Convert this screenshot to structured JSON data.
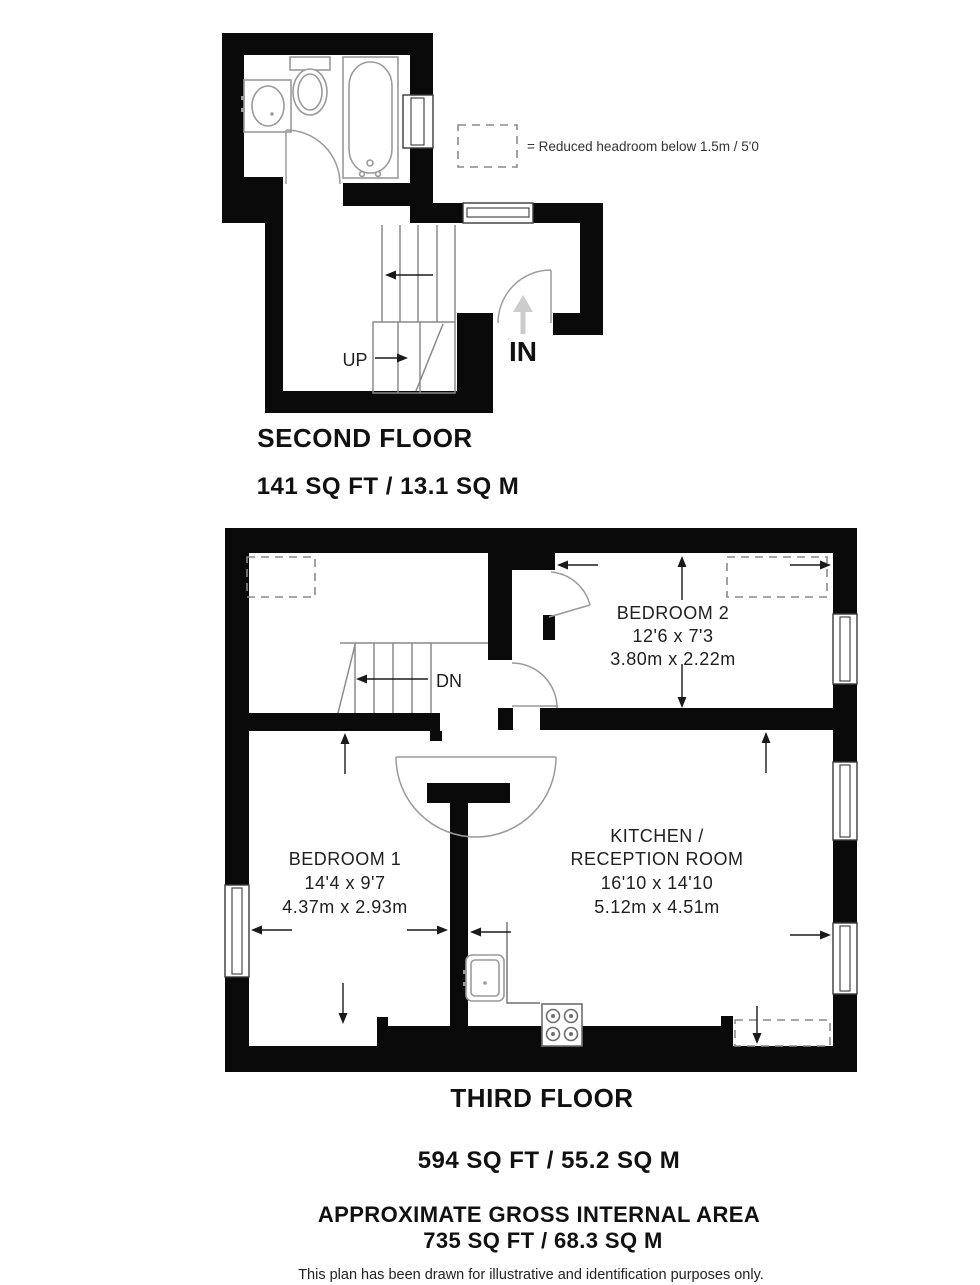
{
  "legend": {
    "label": "= Reduced headroom below 1.5m / 5'0"
  },
  "second_floor": {
    "title": "SECOND FLOOR",
    "area": "141 SQ FT / 13.1 SQ M",
    "stair_label": "UP",
    "entry_label": "IN"
  },
  "third_floor": {
    "title": "THIRD FLOOR",
    "area": "594 SQ FT / 55.2 SQ M",
    "stair_label": "DN",
    "rooms": {
      "bedroom2": {
        "name": "BEDROOM 2",
        "dims_imperial": "12'6 x 7'3",
        "dims_metric": "3.80m x 2.22m"
      },
      "bedroom1": {
        "name": "BEDROOM 1",
        "dims_imperial": "14'4 x 9'7",
        "dims_metric": "4.37m x 2.93m"
      },
      "kitchen": {
        "name_line1": "KITCHEN /",
        "name_line2": "RECEPTION ROOM",
        "dims_imperial": "16'10 x 14'10",
        "dims_metric": "5.12m x 4.51m"
      }
    }
  },
  "summary": {
    "title": "APPROXIMATE GROSS INTERNAL AREA",
    "area": "735 SQ FT / 68.3 SQ M"
  },
  "disclaimer": "This plan has been drawn for illustrative and identification purposes only.",
  "colors": {
    "wall": "#0a0a0a",
    "background": "#ffffff",
    "dashed_outline": "#8a8a8a",
    "entry_arrow": "#cccccc",
    "text": "#111111"
  }
}
